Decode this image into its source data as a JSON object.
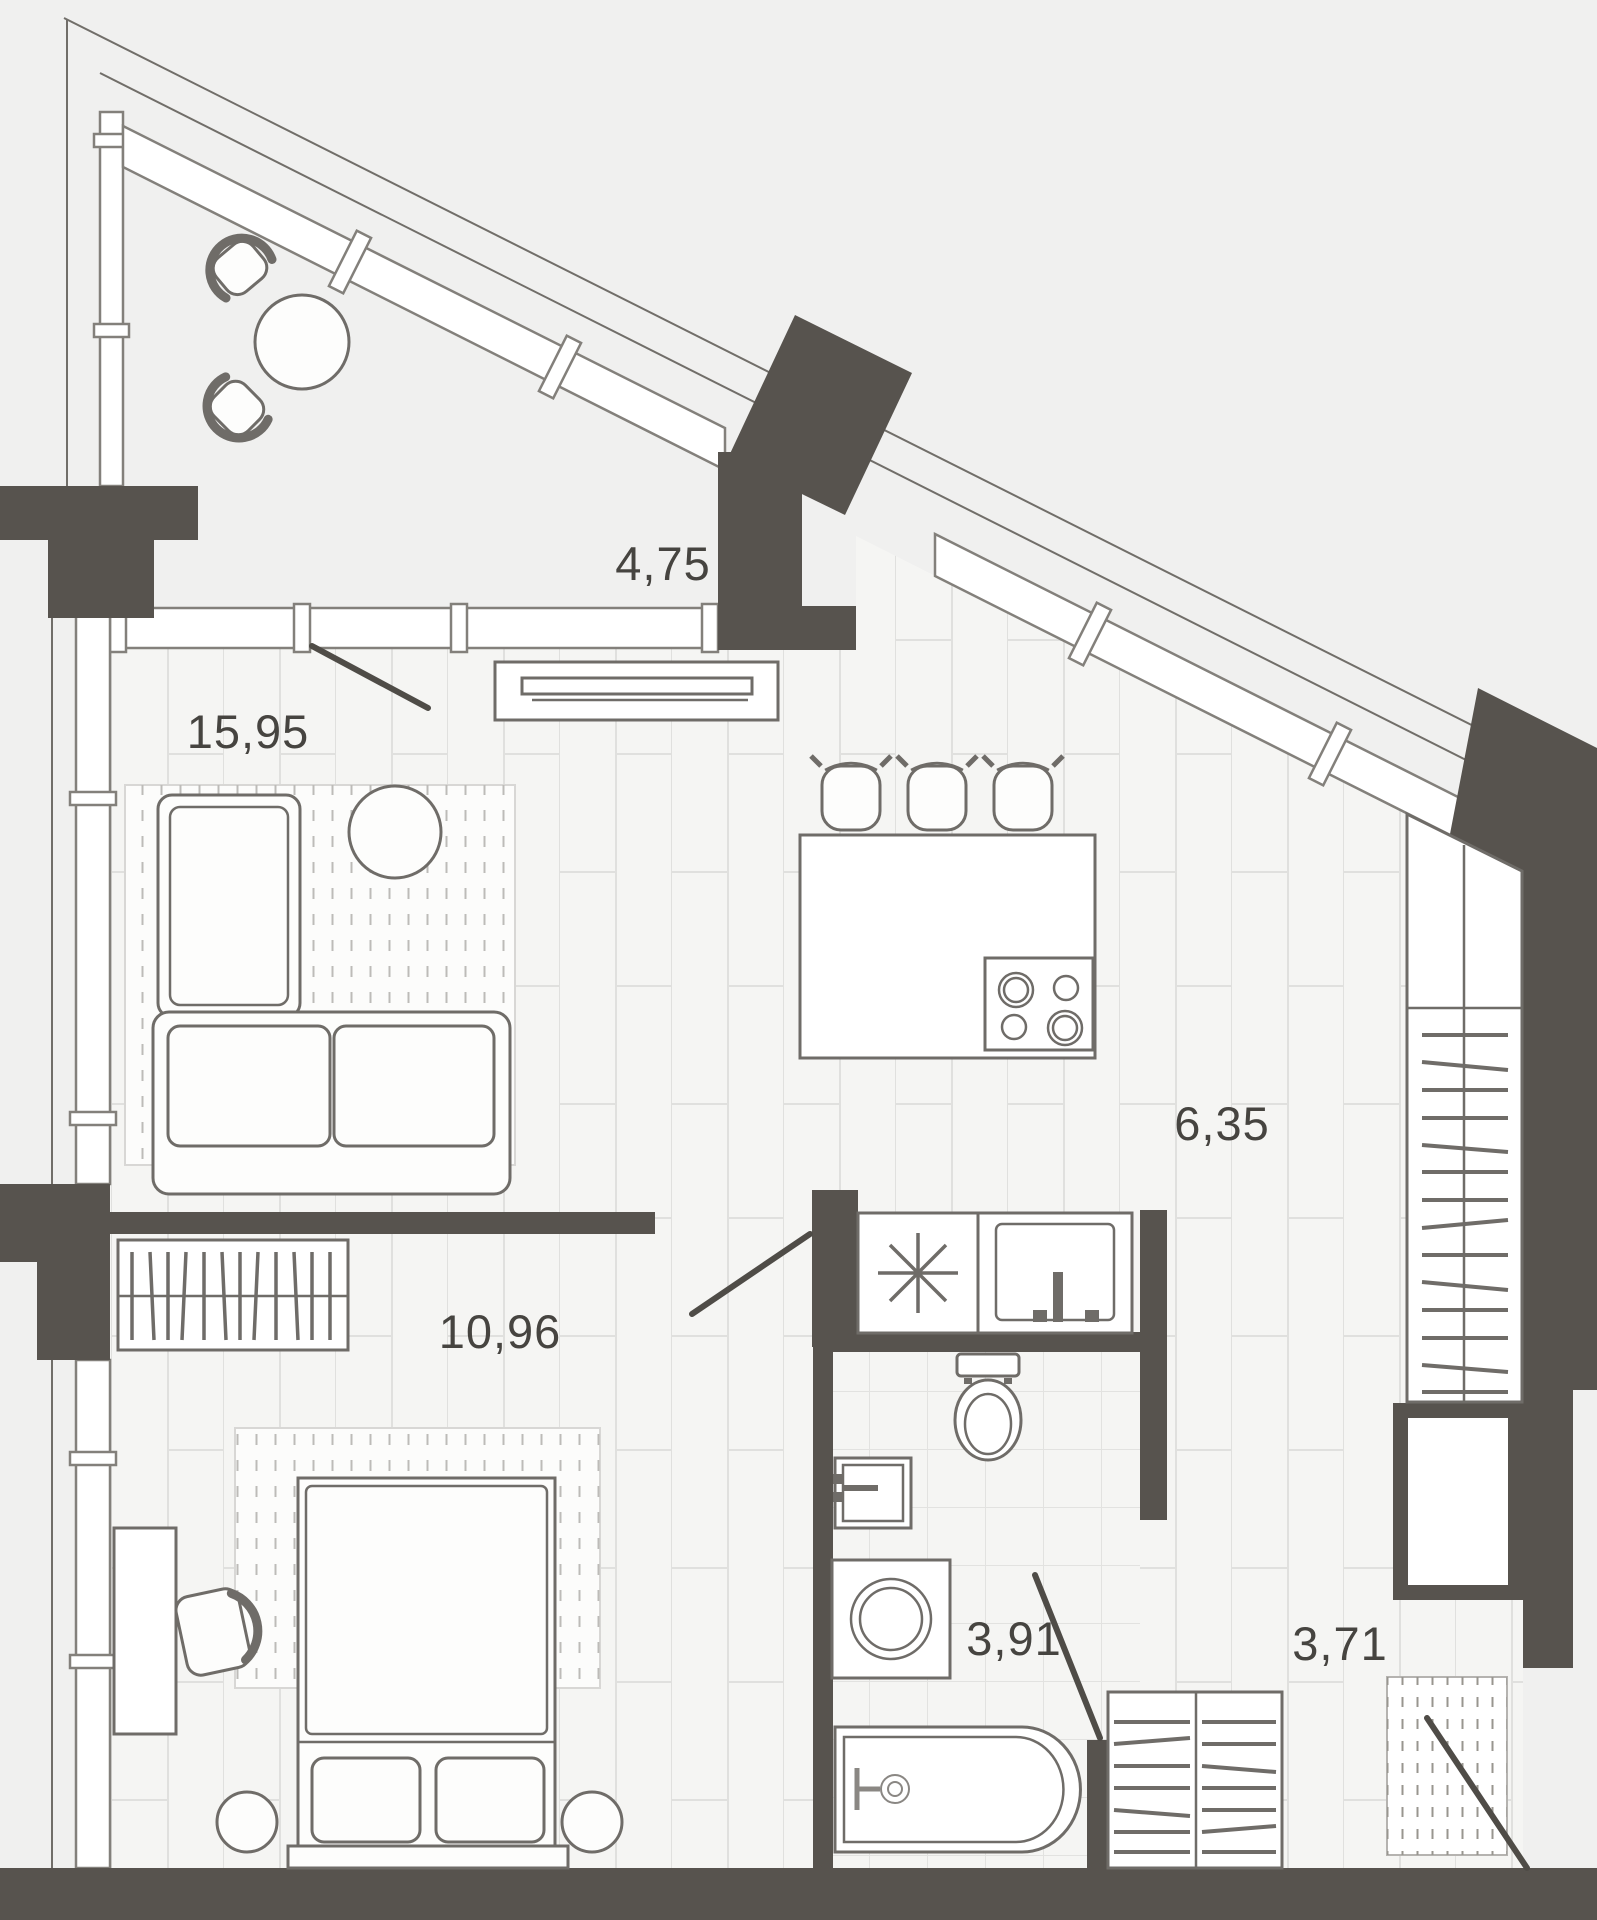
{
  "plan": {
    "type": "apartment-floor-plan",
    "units": "m2",
    "rooms": {
      "balcony": {
        "area": "4,75"
      },
      "living": {
        "area": "15,95"
      },
      "kitchen": {
        "area": "6,35"
      },
      "bedroom": {
        "area": "10,96"
      },
      "bathroom": {
        "area": "3,91"
      },
      "hallway": {
        "area": "3,71"
      }
    },
    "fixtures": [
      "balcony-chair-icon",
      "balcony-table-icon",
      "tv-console-icon",
      "sofa-icon",
      "side-table-icon",
      "kitchen-island-icon",
      "cooktop-icon",
      "bar-stool-icon",
      "fridge-icon",
      "kitchen-sink-icon",
      "hanger-wardrobe-icon",
      "closet-rack-icon",
      "bed-icon",
      "nightstand-icon",
      "desk-icon",
      "desk-chair-icon",
      "toilet-icon",
      "bathroom-sink-icon",
      "washing-machine-icon",
      "bathtub-icon",
      "shoe-cabinet-icon",
      "doormat-icon",
      "door-swing-icon",
      "window-icon",
      "duct-shaft-icon"
    ],
    "colors": {
      "background": "#f0f0ef",
      "wall": "#57534e",
      "line": "#716e69",
      "floor": "#f5f5f3",
      "seam": "#e0e0de",
      "label": "#464440"
    }
  }
}
